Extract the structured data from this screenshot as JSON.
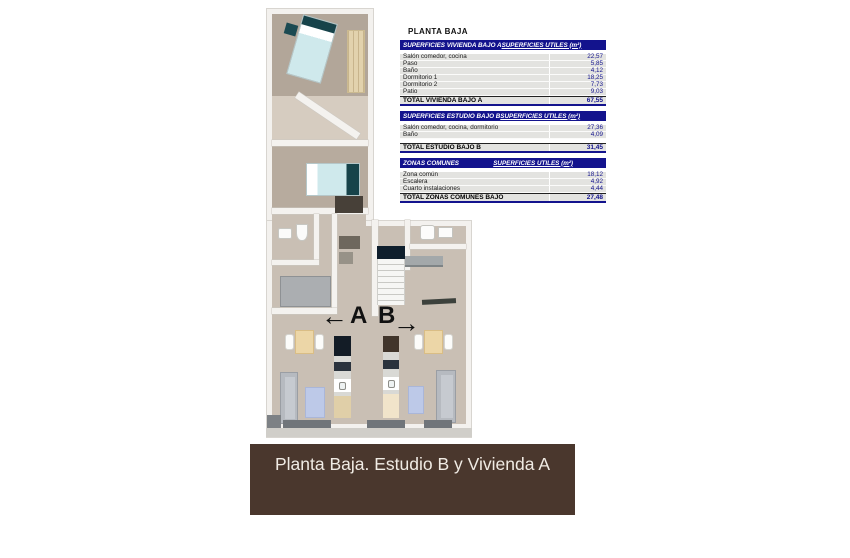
{
  "tables_panel": {
    "title": "PLANTA BAJA",
    "units_label": "SUPERFICIES UTILES  (m²)",
    "tables": [
      {
        "header": "SUPERFICIES VIVIENDA BAJO A",
        "rows": [
          {
            "label": "Salón comedor, cocina",
            "value": "22,57"
          },
          {
            "label": "Paso",
            "value": "5,85"
          },
          {
            "label": "Baño",
            "value": "4,12"
          },
          {
            "label": "Dormitorio 1",
            "value": "18,25"
          },
          {
            "label": "Dormitorio 2",
            "value": "7,73"
          },
          {
            "label": "Patio",
            "value": "9,03"
          }
        ],
        "gap_before_total": false,
        "total": {
          "label": "TOTAL VIVIENDA BAJO A",
          "value": "67,55"
        }
      },
      {
        "header": "SUPERFICIES ESTUDIO BAJO B",
        "rows": [
          {
            "label": "Salón comedor, cocina, dormitorio",
            "value": "27,36"
          },
          {
            "label": "Baño",
            "value": "4,09"
          }
        ],
        "gap_before_total": true,
        "total": {
          "label": "TOTAL ESTUDIO BAJO B",
          "value": "31,45"
        }
      },
      {
        "header": "ZONAS COMUNES",
        "rows": [
          {
            "label": "Zona común",
            "value": "18,12"
          },
          {
            "label": "Escalera",
            "value": "4,92"
          },
          {
            "label": "Cuarto instalaciones",
            "value": "4,44"
          }
        ],
        "gap_before_total": false,
        "total": {
          "label": "TOTAL ZONAS COMUNES BAJO",
          "value": "27,48"
        }
      }
    ]
  },
  "plan": {
    "label_a": "A",
    "label_b": "B",
    "arrow_left": "←",
    "arrow_right": "→"
  },
  "banner": {
    "text": "Planta Baja. Estudio B y Vivienda A"
  },
  "colors": {
    "table_header_bg": "#13138d",
    "value_text": "#13138d",
    "row_bg": "#e3e3e0",
    "banner_bg": "#4a372d"
  }
}
